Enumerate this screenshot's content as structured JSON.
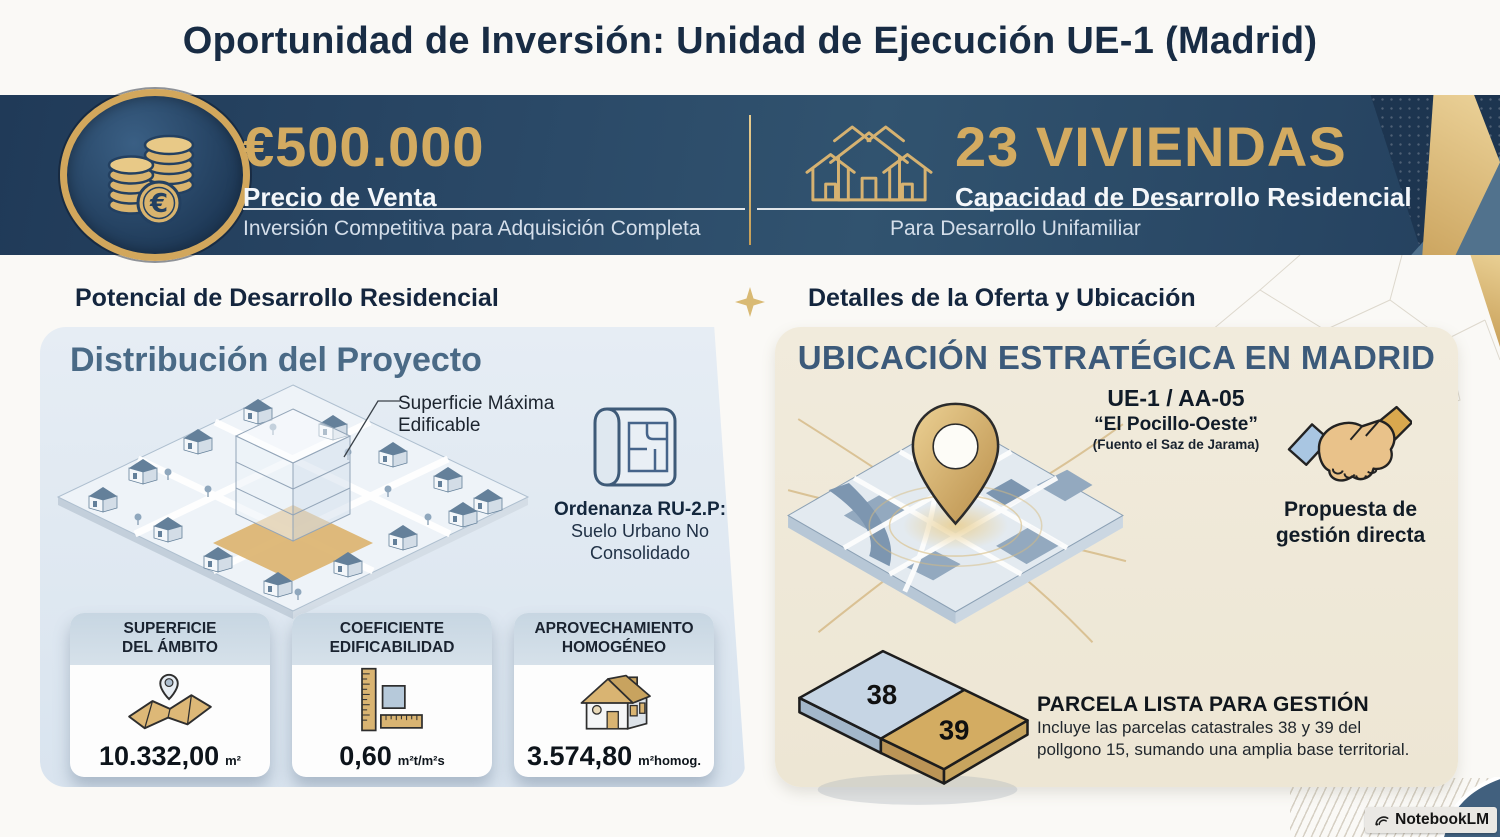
{
  "page": {
    "title": "Oportunidad de Inversión: Unidad de Ejecución UE-1 (Madrid)"
  },
  "banner": {
    "price": {
      "value": "€500.000",
      "label": "Precio de Venta",
      "subtext": "Inversión Competitiva para Adquisición Completa"
    },
    "units": {
      "value": "23 VIVIENDAS",
      "label": "Capacidad de Desarrollo Residencial",
      "subtext": "Para Desarrollo Unifamiliar"
    }
  },
  "left_section": {
    "heading": "Potencial de Desarrollo Residencial",
    "panel_title": "Distribución del Proyecto",
    "annotation_line1": "Superficie Máxima",
    "annotation_line2": "Edificable",
    "ordenanza": {
      "title": "Ordenanza RU-2.P:",
      "line1": "Suelo Urbano No",
      "line2": "Consolidado"
    },
    "cards": [
      {
        "title_line1": "SUPERFICIE",
        "title_line2": "DEL ÁMBITO",
        "value": "10.332,00",
        "unit": "m²",
        "icon": "map-pin-icon"
      },
      {
        "title_line1": "COEFICIENTE",
        "title_line2": "EDIFICABILIDAD",
        "value": "0,60",
        "unit": "m²t/m²s",
        "icon": "ruler-icon"
      },
      {
        "title_line1": "APROVECHAMIENTO",
        "title_line2": "HOMOGÉNEO",
        "value": "3.574,80",
        "unit": "m²homog.",
        "icon": "house-icon"
      }
    ]
  },
  "right_section": {
    "heading": "Detalles de la Oferta y Ubicación",
    "panel_title": "UBICACIÓN ESTRATÉGICA EN MADRID",
    "location": {
      "code": "UE-1 / AA-05",
      "name": "“El Pocillo-Oeste”",
      "municipality": "(Fuento el Saz de Jarama)"
    },
    "proposal": {
      "line1": "Propuesta de",
      "line2": "gestión directa"
    },
    "parcels": {
      "parcel_a": "38",
      "parcel_b": "39"
    },
    "parcel_info": {
      "title": "PARCELA LISTA PARA GESTIÓN",
      "line1": "Incluye las parcelas catastrales 38 y 39 del",
      "line2": "pollgono 15, sumando una amplia base territorial."
    }
  },
  "watermark": {
    "label": "NotebookLM"
  },
  "colors": {
    "banner_navy": "#24405e",
    "gold": "#d3ab61",
    "panel_blue": "#dde7f0",
    "panel_cream": "#f0ead9",
    "heading_navy": "#14263e",
    "slate_title": "#3c5a7a"
  }
}
